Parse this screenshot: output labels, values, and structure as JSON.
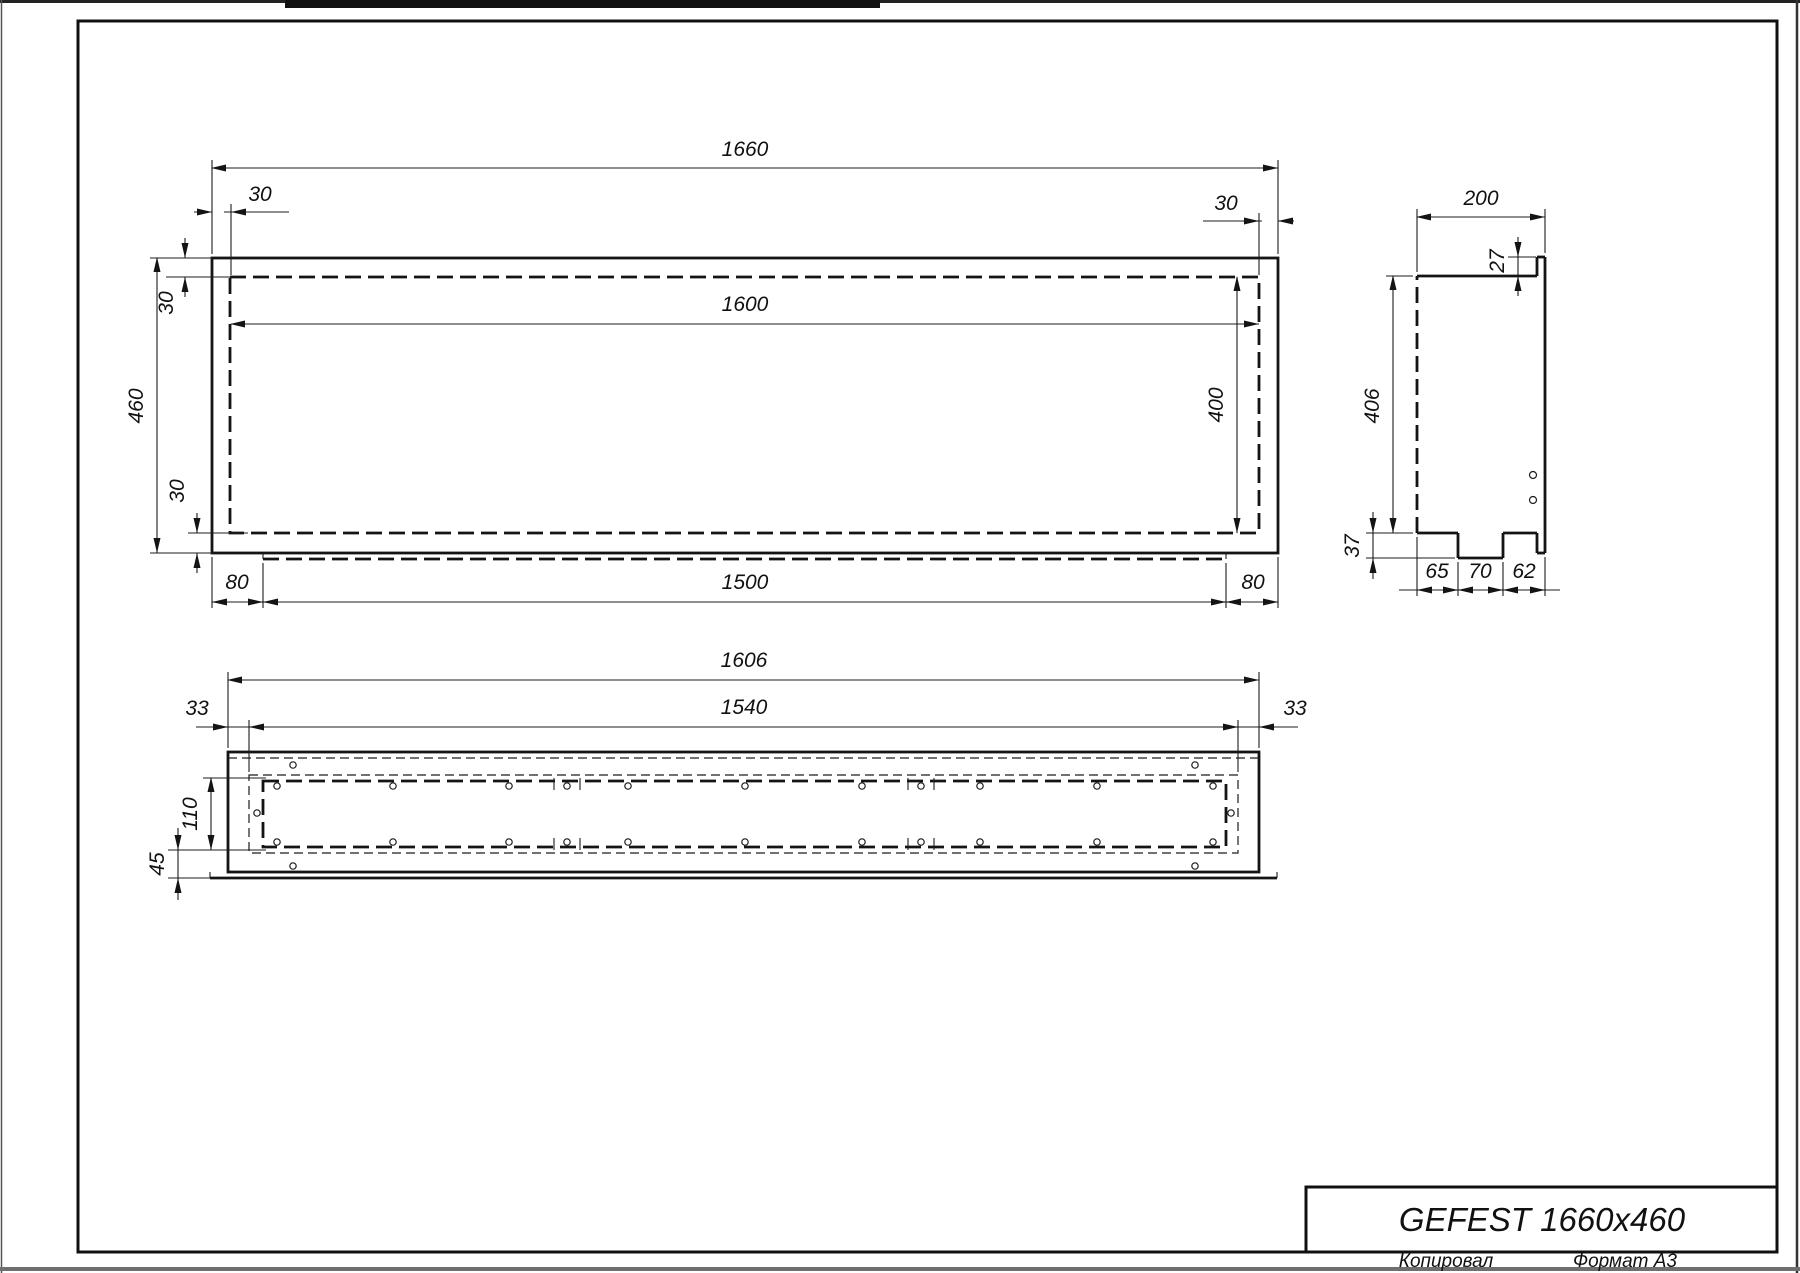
{
  "title_block": {
    "title": "GEFEST 1660x460",
    "copied_label": "Копировал",
    "format_label": "Формат А3"
  },
  "views": {
    "front": {
      "labels": {
        "overall_width": "1660",
        "inner_width": "1600",
        "overall_height": "460",
        "inner_height": "400",
        "wall_top_left": "30",
        "wall_top_right": "30",
        "wall_left_top": "30",
        "wall_left_bottom": "30",
        "lip_left": "80",
        "lip_width": "1500",
        "lip_right": "80"
      }
    },
    "side": {
      "labels": {
        "depth": "200",
        "rim": "27",
        "height": "406",
        "tab_height": "37",
        "seg1": "65",
        "seg2": "70",
        "seg3": "62"
      }
    },
    "bottom": {
      "labels": {
        "overall_width": "1606",
        "slot_width": "1540",
        "edge_left": "33",
        "edge_right": "33",
        "slot_height": "110",
        "flange": "45"
      }
    }
  },
  "colors": {
    "line": "#1c1c1c",
    "paper": "#ffffff"
  }
}
